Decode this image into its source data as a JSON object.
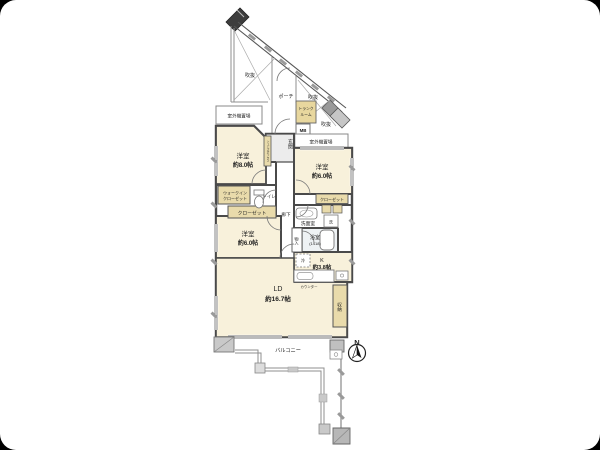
{
  "plan": {
    "rooms": {
      "bedroom_8": {
        "label": "洋室",
        "size": "約8.0帖"
      },
      "bedroom_6_east": {
        "label": "洋室",
        "size": "約6.0帖"
      },
      "bedroom_6_west": {
        "label": "洋室",
        "size": "約6.0帖"
      },
      "living_dining": {
        "label": "LD",
        "size": "約16.7帖"
      },
      "kitchen": {
        "label": "K",
        "size": "約3.8帖"
      },
      "bathroom": {
        "label": "浴室",
        "size": "(1418)"
      },
      "washroom": {
        "label": "洗面室"
      },
      "toilet": {
        "label": "トイレ"
      },
      "hallway": {
        "label": "廊下"
      },
      "entrance": {
        "label": "玄関"
      }
    },
    "storage": {
      "walk_in_closet": {
        "line1": "ウォークイン",
        "line2": "クローゼット"
      },
      "closet_west": {
        "label": "クローゼット"
      },
      "closet_east": {
        "label": "クローゼット"
      },
      "futon_storage": {
        "label": "物入"
      },
      "living_storage": {
        "label": "収納"
      },
      "shoes_box": {
        "label": "シューズボックス"
      },
      "trunk_room": {
        "line1": "トランク",
        "line2": "ルーム"
      },
      "meter_box": {
        "label": "MB"
      }
    },
    "exterior": {
      "balcony": {
        "label": "バルコニー"
      },
      "porch": {
        "label": "ポーチ"
      },
      "void_west": {
        "label": "吹抜"
      },
      "void_center": {
        "label": "吹抜"
      },
      "void_east": {
        "label": "吹抜"
      },
      "ac_unit_west": {
        "label": "室外機置場"
      },
      "ac_unit_east": {
        "label": "室外機置場"
      }
    },
    "fixtures": {
      "refrigerator": {
        "label": "冷"
      },
      "washer": {
        "label": "洗"
      },
      "counter": {
        "label": "カウンター"
      }
    },
    "compass": {
      "label": "N"
    },
    "colors": {
      "room_fill": "#f8f1db",
      "closet_fill": "#e9dbab",
      "trunk_fill": "#e8d79e",
      "wall": "#4a4a4a",
      "bath_fill": "#eef2f4",
      "entrance_fill": "#ececec",
      "outline_gray": "#999999"
    }
  }
}
